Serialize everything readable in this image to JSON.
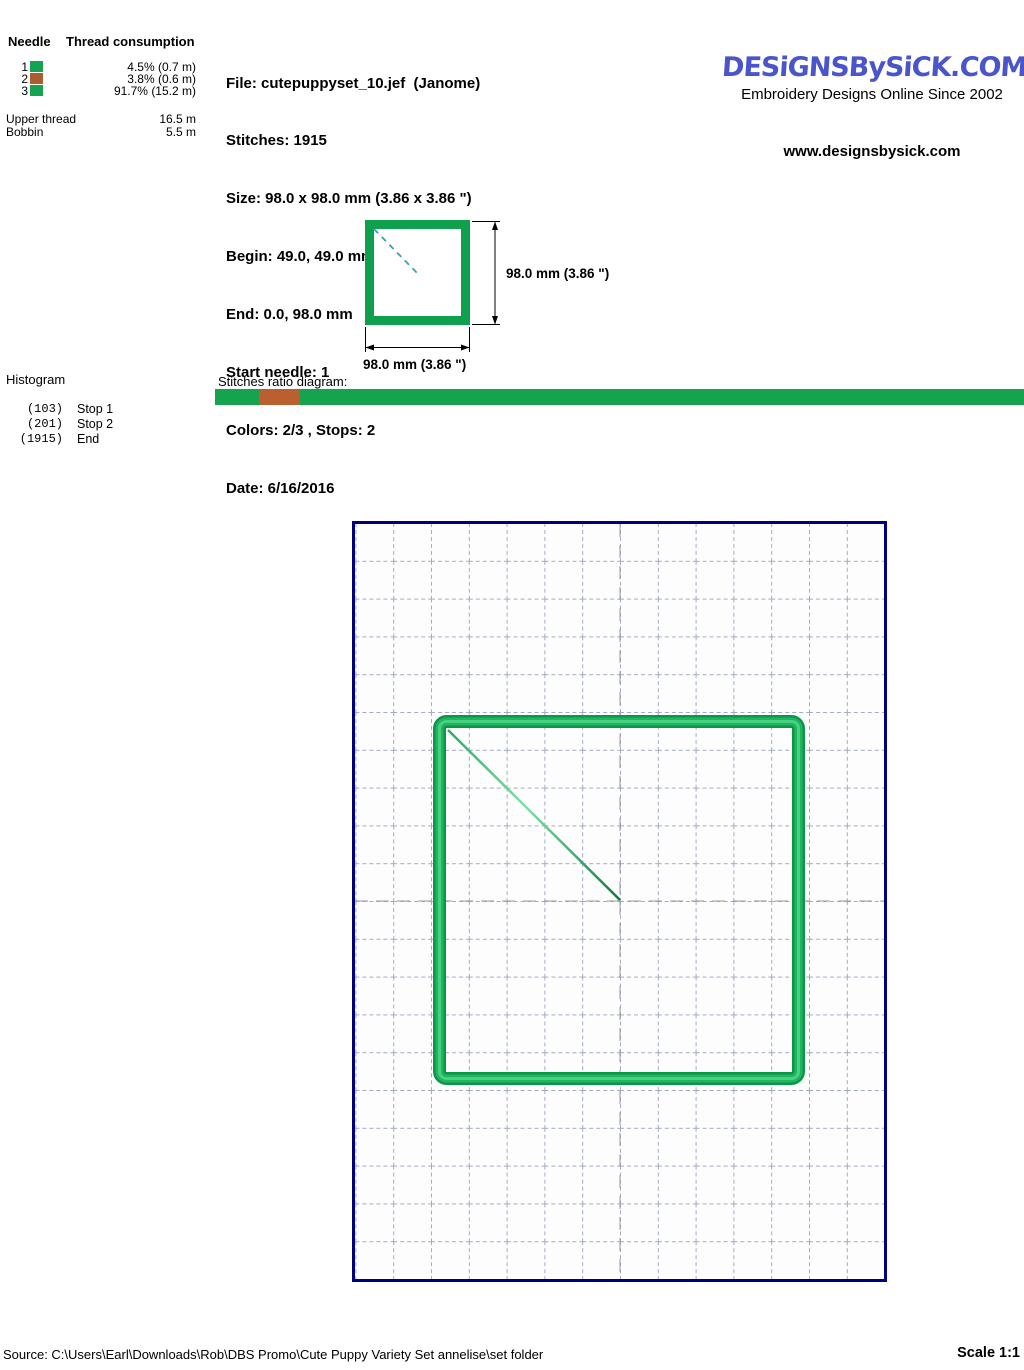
{
  "thread_table": {
    "header_needle": "Needle",
    "header_consumption": "Thread consumption",
    "rows": [
      {
        "needle": "1",
        "color": "#15a350",
        "percent": "4.5% (0.7 m)"
      },
      {
        "needle": "2",
        "color": "#aa5e2f",
        "percent": "3.8% (0.6 m)"
      },
      {
        "needle": "3",
        "color": "#15a350",
        "percent": "91.7% (15.2 m)"
      }
    ],
    "upper_thread_label": "Upper thread",
    "upper_thread_value": "16.5 m",
    "bobbin_label": "Bobbin",
    "bobbin_value": "5.5 m"
  },
  "file_info": {
    "lines": [
      "File: cutepuppyset_10.jef  (Janome)",
      "Stitches: 1915",
      "Size: 98.0 x 98.0 mm (3.86 x 3.86 \")",
      "Begin: 49.0, 49.0 mm",
      "End: 0.0, 98.0 mm",
      "Start needle: 1",
      "Colors: 2/3 , Stops: 2",
      "Date: 6/16/2016"
    ]
  },
  "branding": {
    "logo_text": "DESiGNSBySiCK.COM",
    "logo_color": "#4a55cc",
    "tagline": "Embroidery Designs Online Since 2002",
    "website": "www.designsbysick.com"
  },
  "size_diagram": {
    "height_label": "98.0 mm (3.86 \")",
    "width_label": "98.0 mm (3.86 \")"
  },
  "histogram": {
    "title": "Histogram",
    "rows": [
      {
        "count": "(103)",
        "label": "Stop 1"
      },
      {
        "count": "(201)",
        "label": "Stop 2"
      },
      {
        "count": "(1915)",
        "label": "End"
      }
    ]
  },
  "ratio_diagram": {
    "label": "Stitches ratio diagram:",
    "segments": [
      {
        "color": "#15a350",
        "width_pct": 5.4
      },
      {
        "color": "#bb5f30",
        "width_pct": 5.1
      },
      {
        "color": "#15a350",
        "width_pct": 89.5
      }
    ]
  },
  "preview": {
    "border_color": "#00007d",
    "grid_color": "#a3abc4",
    "stitch_green": "#0fa04e",
    "stitch_highlight": "#49cf82"
  },
  "footer": {
    "source": "Source: C:\\Users\\Earl\\Downloads\\Rob\\DBS Promo\\Cute Puppy Variety Set annelise\\set folder",
    "scale": "Scale 1:1"
  }
}
